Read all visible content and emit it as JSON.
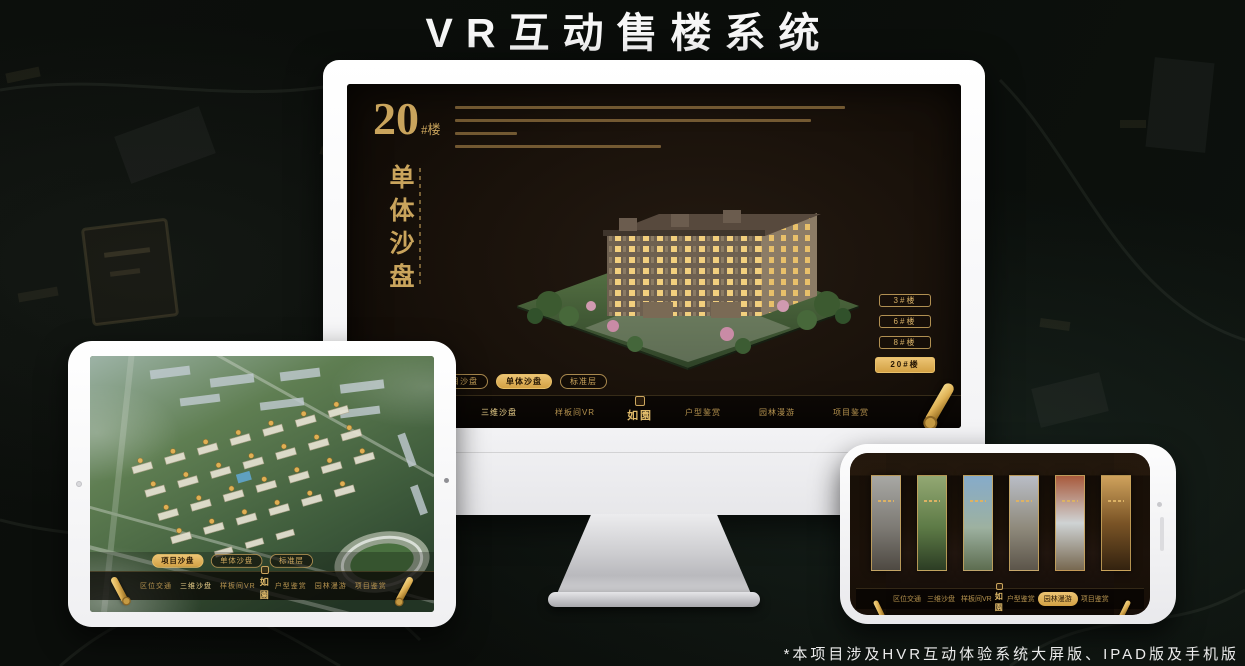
{
  "banner": {
    "title": "VR互动售楼系统"
  },
  "footnote": {
    "text": "*本项目涉及HVR互动体验系统大屏版、IPAD版及手机版"
  },
  "logo": {
    "text": "如園"
  },
  "nav": {
    "items": [
      {
        "label": "区位交通"
      },
      {
        "label": "三维沙盘"
      },
      {
        "label": "样板间VR"
      },
      {
        "label": "户型鉴赏"
      },
      {
        "label": "园林漫游"
      },
      {
        "label": "项目鉴赏"
      }
    ]
  },
  "sub_tabs": [
    {
      "label": "项目沙盘"
    },
    {
      "label": "单体沙盘"
    },
    {
      "label": "标准层"
    }
  ],
  "monitor": {
    "block_number": "20",
    "block_unit": "#楼",
    "vertical_title": "单体沙盘",
    "floor_buttons": [
      {
        "label": "3#楼",
        "active": false
      },
      {
        "label": "6#楼",
        "active": false
      },
      {
        "label": "8#楼",
        "active": false
      },
      {
        "label": "20#楼",
        "active": true
      }
    ],
    "active_sub_tab": "单体沙盘",
    "active_nav": "三维沙盘"
  },
  "tablet": {
    "active_sub_tab": "项目沙盘",
    "active_nav": "三维沙盘"
  },
  "phone": {
    "active_nav": "园林漫游"
  },
  "colors": {
    "gold": "#C9A45C",
    "gold_bright": "#E8C06A",
    "screen_dark": "#17100A",
    "page_bg": "#0B0E0B"
  }
}
